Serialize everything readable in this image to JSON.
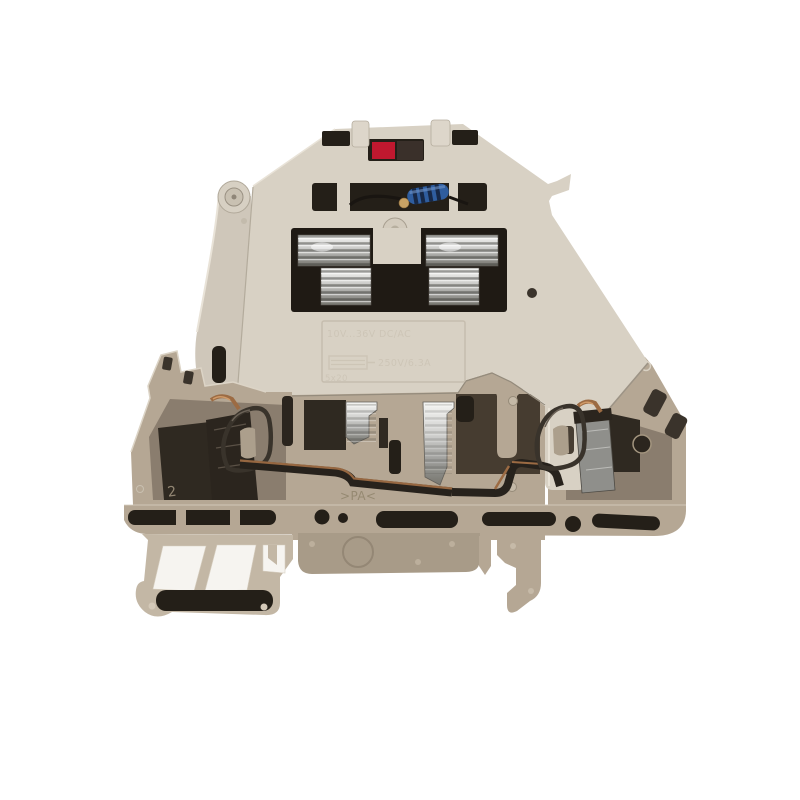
{
  "photo": {
    "subject": "DIN-rail fuse terminal block with LED blown-fuse indicator, cross-section side view",
    "style": "product photo on white background"
  },
  "markings": {
    "rating_line": "10V...36V DC/AC",
    "fuse_rating": "250V/6.3A",
    "fuse_size": "5x20",
    "pole_mark": "2",
    "material_mark": ">PA<"
  },
  "colors": {
    "background": "#ffffff",
    "lever": "#d8d1c4",
    "lever_shade": "#cfc7ba",
    "lower_body": "#b5a794",
    "lower_body_light": "#c3b7a5",
    "band": "#a89b88",
    "cavity": "#8a7d6e",
    "cavity_deep": "#2f2921",
    "slot": "#241f18",
    "led_red": "#c0182f",
    "resistor_blue": "#2f5d9e",
    "copper": "#9c6b43",
    "spring": "#39332b",
    "emboss": "#cdc5b6"
  }
}
